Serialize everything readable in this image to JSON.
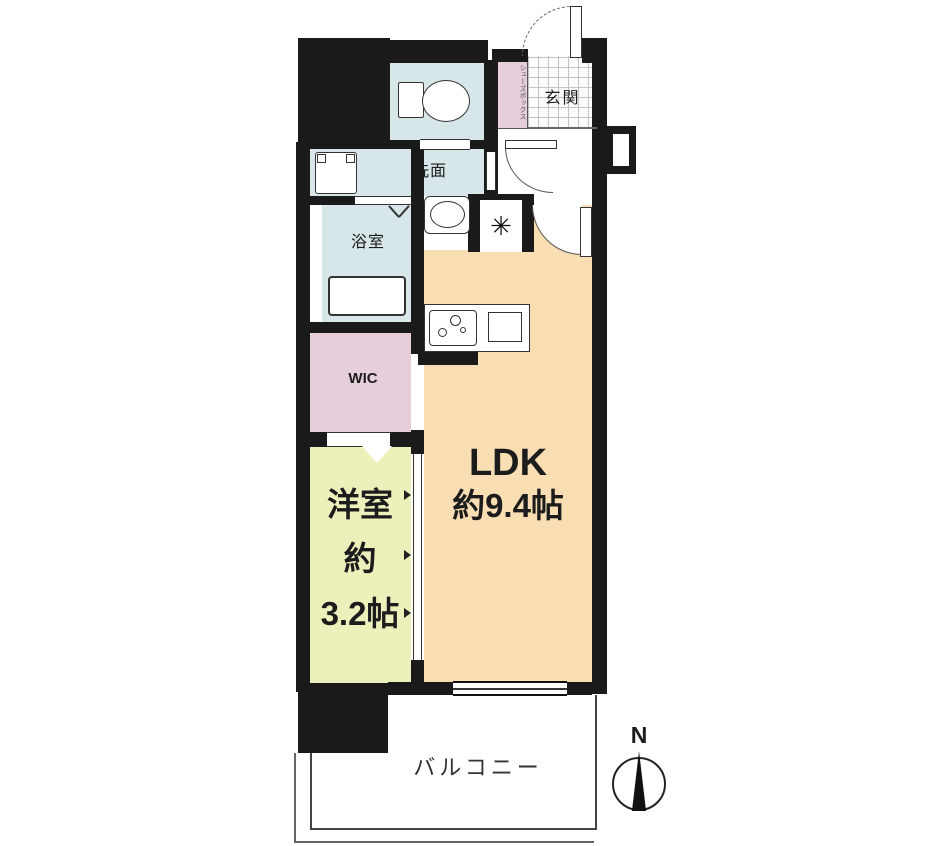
{
  "plan": {
    "title": "1LDK apartment floor plan",
    "rooms": {
      "genkan": {
        "label": "玄関"
      },
      "shoe_box": {
        "label": "シューズボックス"
      },
      "toilet": {
        "label": ""
      },
      "washroom": {
        "label": "洗面"
      },
      "bathroom": {
        "label": "浴室"
      },
      "wic": {
        "label": "WIC"
      },
      "western_room": {
        "label": "洋室",
        "size_prefix": "約",
        "size": "3.2帖"
      },
      "ldk": {
        "label": "LDK",
        "size": "約9.4帖"
      },
      "balcony": {
        "label": "バルコニー"
      }
    },
    "compass": {
      "label": "N"
    },
    "symbols": {
      "refrigerator": "✳"
    },
    "colors": {
      "wall": "#1a1a1a",
      "wet_area": "#d6e6e9",
      "closet": "#e6cedb",
      "ldk": "#f8deb2",
      "western_room": "#eef0bc"
    }
  }
}
